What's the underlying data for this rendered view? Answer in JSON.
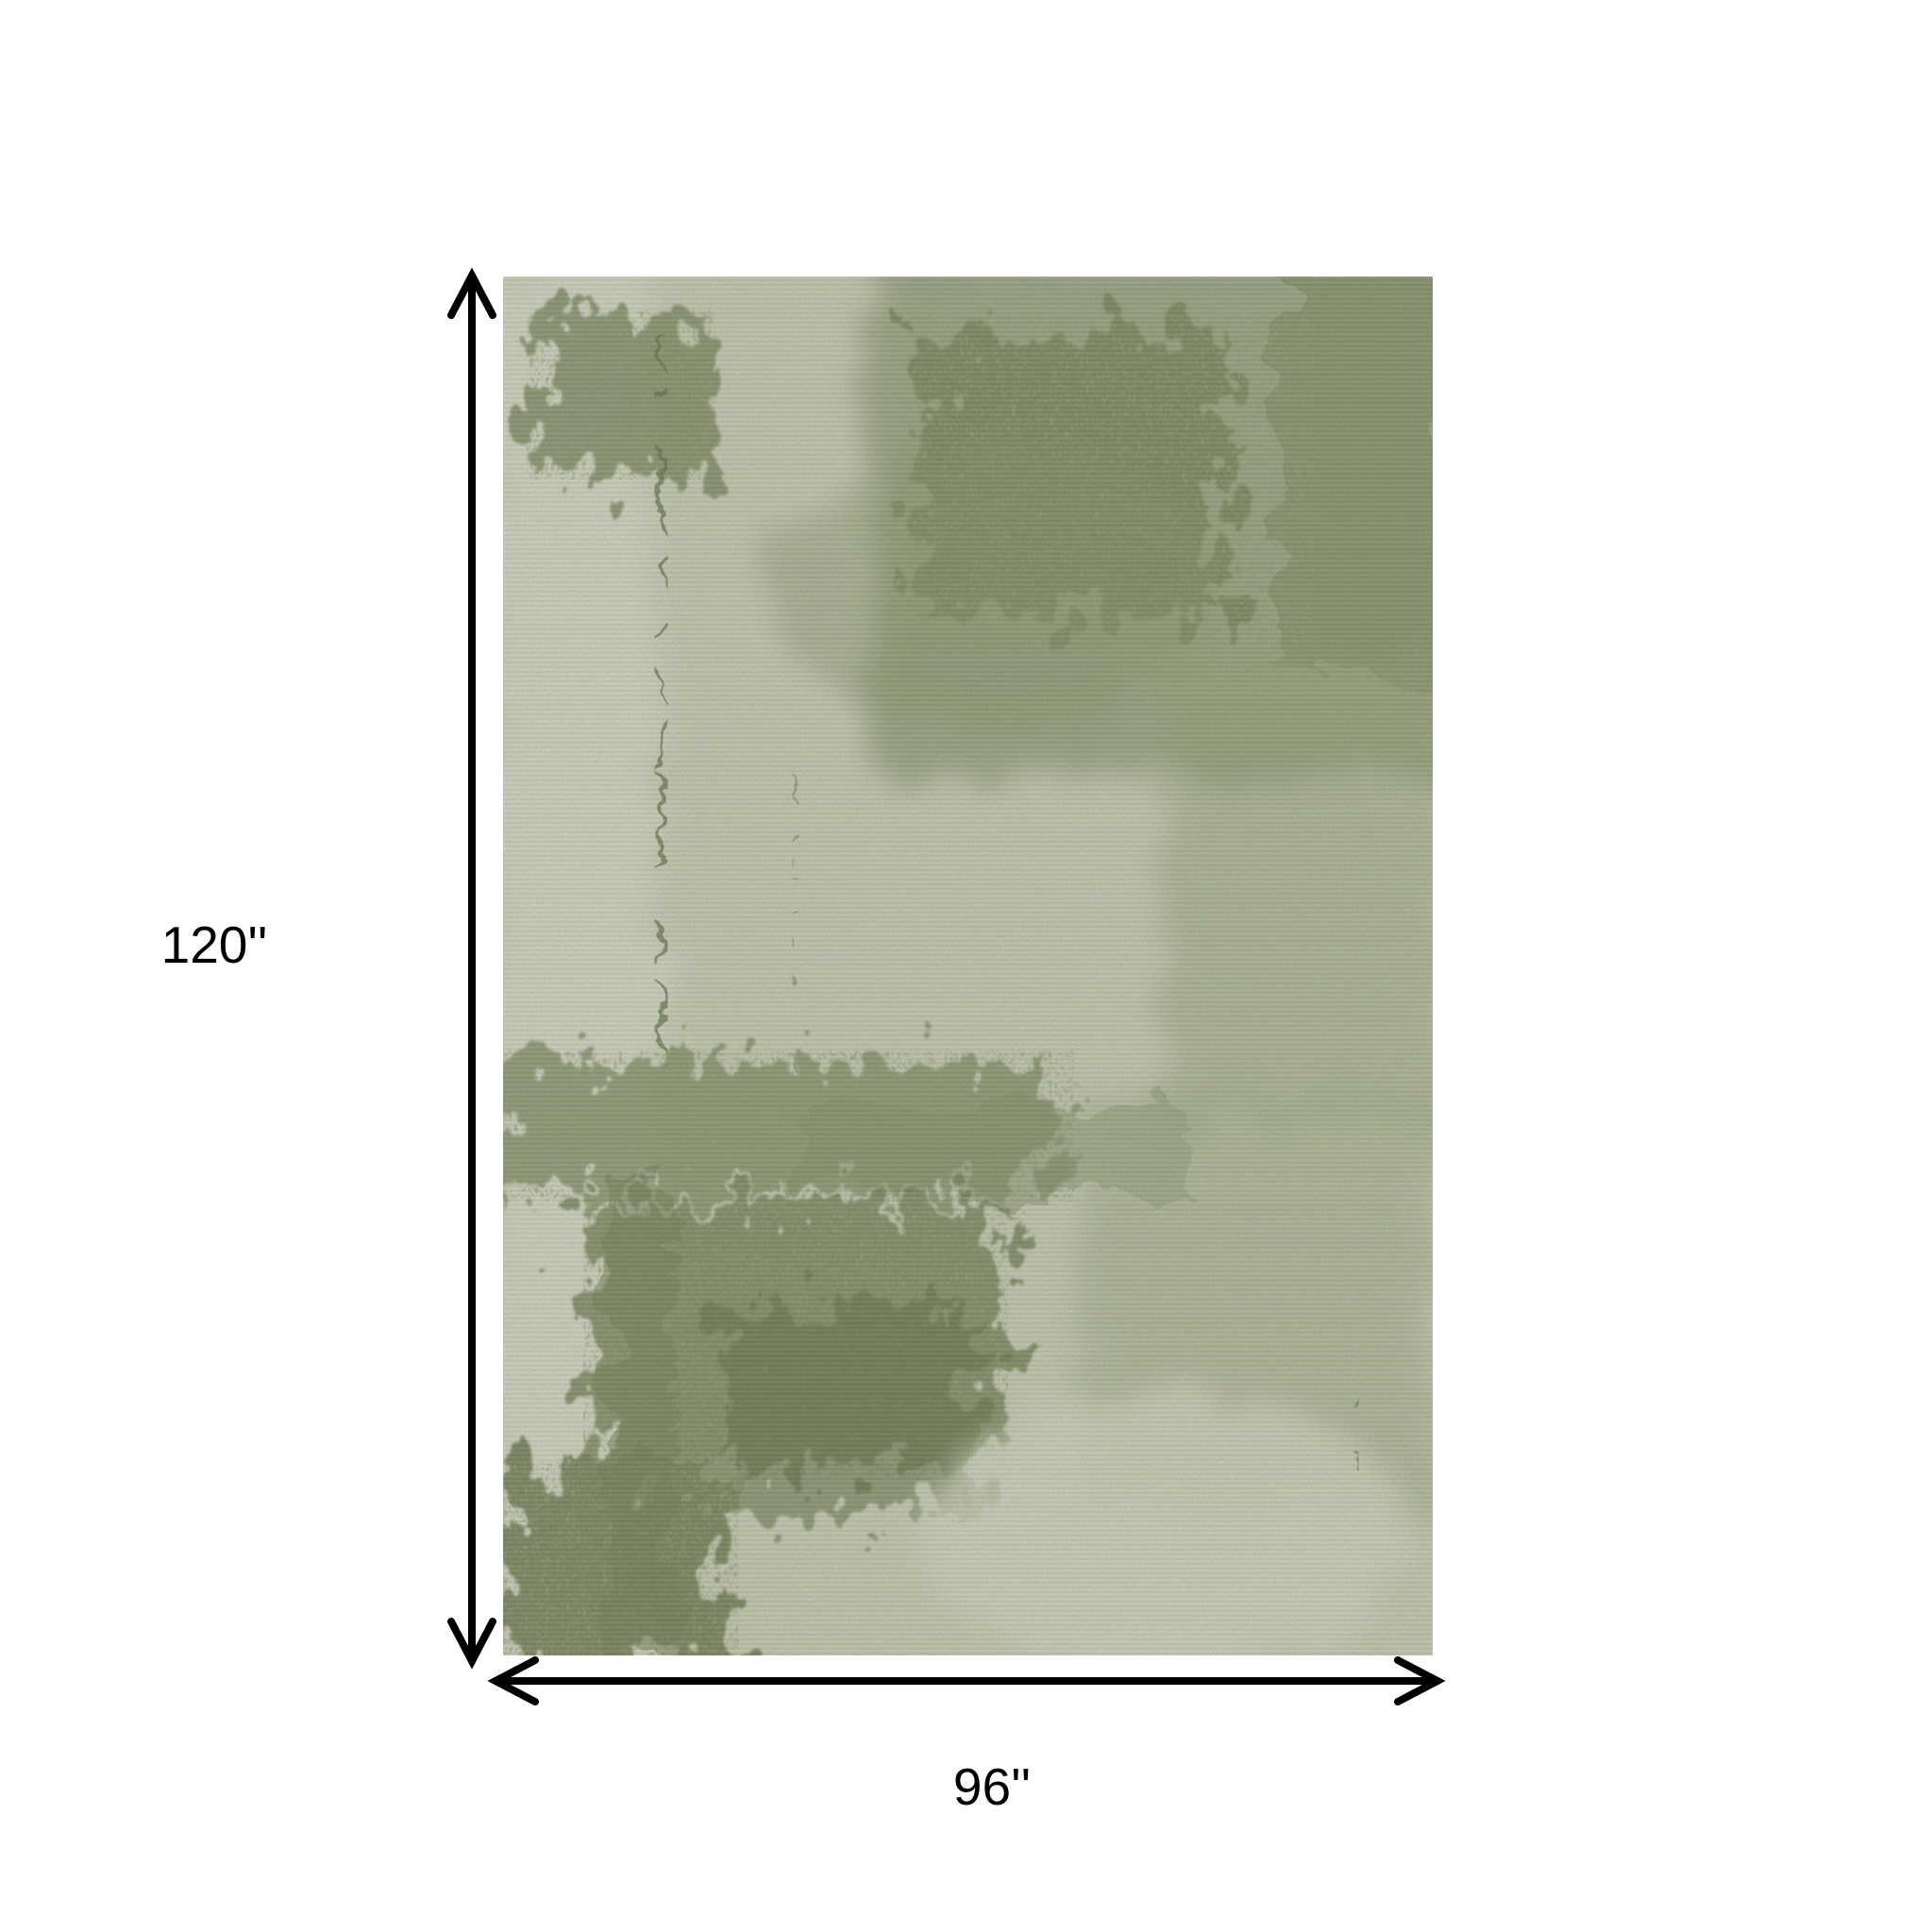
{
  "diagram": {
    "height_label": "120''",
    "width_label": "96''"
  },
  "colors": {
    "background": "#ffffff",
    "dimension_lines": "#000000",
    "label_text": "#000000",
    "rug_base": "#c4c8b5",
    "rug_light": "#d3d6c7",
    "rug_olive_mid": "#8b9372",
    "rug_olive_dark": "#6e7954"
  }
}
